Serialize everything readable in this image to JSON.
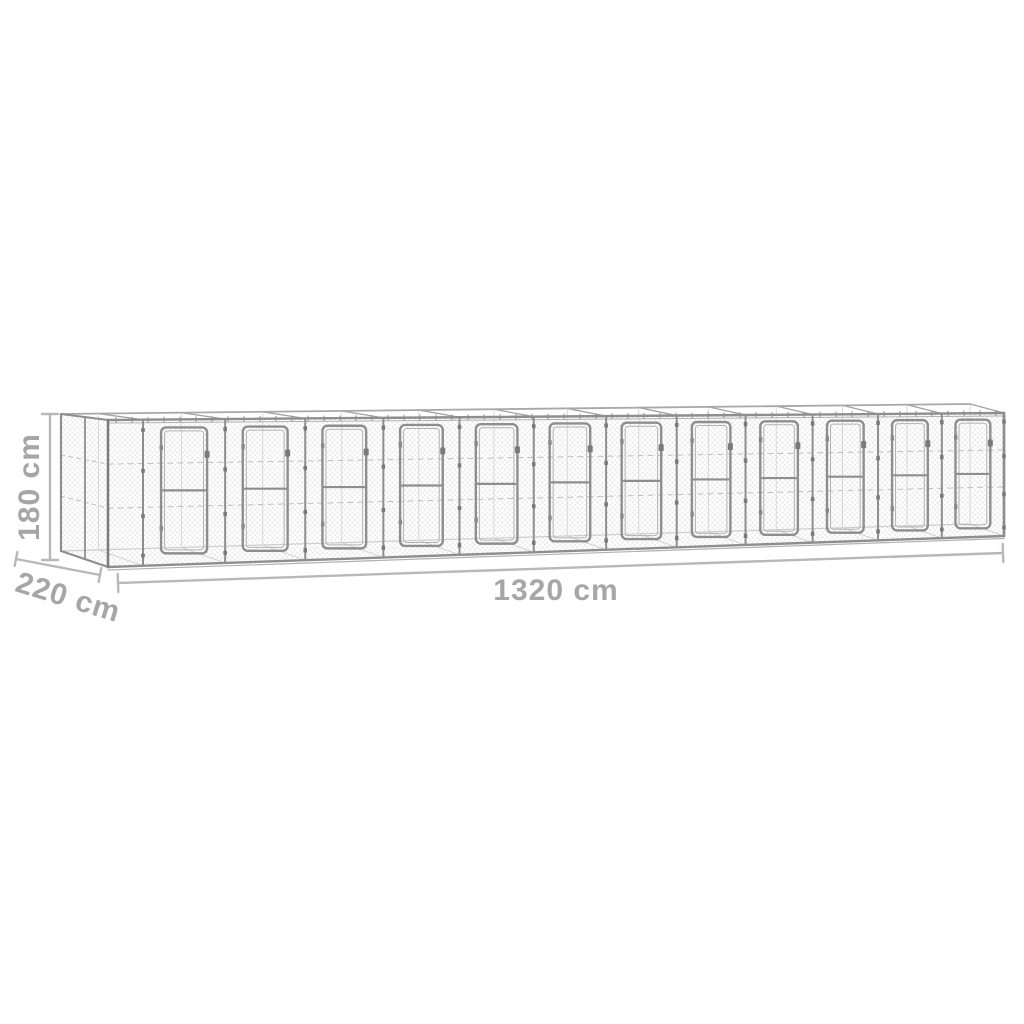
{
  "figure": {
    "type": "product-dimension-diagram",
    "subject": "outdoor chain-link dog kennel with 12 door panels, galvanized steel wireframe drawing",
    "canvas": {
      "width": 1024,
      "height": 1024
    },
    "colors": {
      "background": "#ffffff",
      "frame": "#8e8e8e",
      "frame_dark": "#7d7d7d",
      "frame_light": "#b2b2b2",
      "mesh": "#dcdcdc",
      "interior": "#cdcdcd",
      "tension_wire": "#bfbfbf",
      "clamp": "#7a7a7a",
      "dim_line": "#b8b8b8",
      "dim_text": "#a6a6a6"
    },
    "kennel": {
      "module_count": 12,
      "front": {
        "x0": 108,
        "x1": 1004,
        "top_y0": 420,
        "top_y1": 413,
        "bot_y0": 567,
        "bot_y1": 536,
        "lead_mesh_x": 143,
        "shrink": 0.975
      },
      "back": {
        "dx0": -45,
        "dx1": -34,
        "dy_top0": -6,
        "dy_top1": -9,
        "bot_y0": 551,
        "bot_y1": 524
      },
      "side": {
        "back_x": 61,
        "back_top": 414,
        "back_bot": 551,
        "mid_x": 85
      },
      "door": {
        "width_frac": 0.56,
        "top_inset": 8,
        "bot_inset": 11,
        "mid_rail_frac": 0.5,
        "corner_radius": 5,
        "latch_frac": 0.21
      },
      "mesh_cell": 5,
      "tension_wire_fracs": [
        0.3,
        0.6
      ]
    },
    "dimensions": {
      "height": {
        "label": "180 cm",
        "value_cm": 180,
        "line": {
          "x1": 50,
          "y1": 414,
          "x2": 50,
          "y2": 560
        },
        "cap_len": 16,
        "font_px": 30,
        "label_pos": {
          "x": 30,
          "y": 487,
          "rotation_deg": -90
        }
      },
      "depth": {
        "label": "220 cm",
        "value_cm": 220,
        "line": {
          "x1": 16,
          "y1": 559,
          "x2": 100,
          "y2": 575
        },
        "cap_len": 14,
        "font_px": 30,
        "label_pos": {
          "x": 68,
          "y": 598,
          "rotation_deg": 17
        }
      },
      "width": {
        "label": "1320 cm",
        "value_cm": 1320,
        "line": {
          "x1": 118,
          "y1": 583,
          "x2": 1003,
          "y2": 553
        },
        "cap_len": 18,
        "font_px": 30,
        "label_pos": {
          "x": 556,
          "y": 591,
          "rotation_deg": 0
        }
      }
    }
  }
}
